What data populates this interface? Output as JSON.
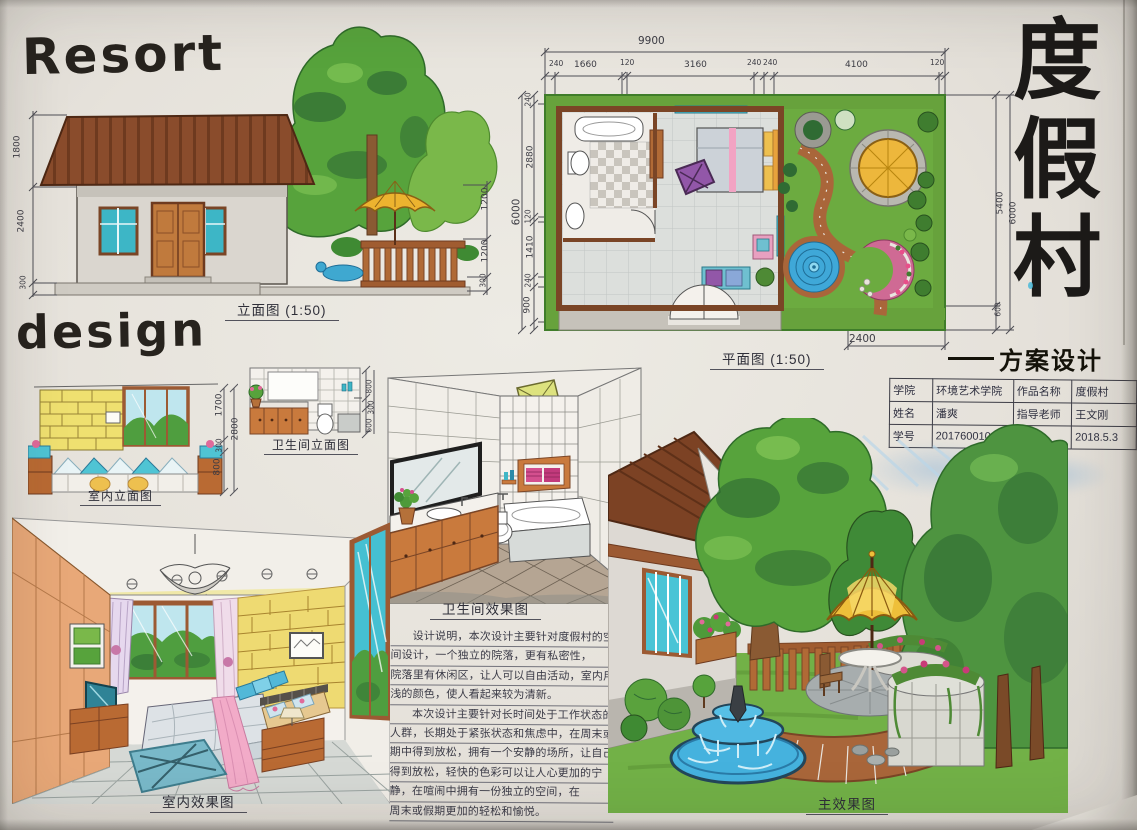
{
  "titles": {
    "resort": "Resort",
    "design": "design",
    "main_title_chars": [
      "度",
      "假",
      "村"
    ],
    "scheme_label": "方案设计"
  },
  "elevation": {
    "caption": "立面图 (1:50)",
    "dims_left": [
      "1800",
      "2400",
      "300"
    ],
    "dims_right": [
      "1200",
      "1200",
      "300"
    ]
  },
  "interior_elevation": {
    "caption": "室内立面图",
    "dims_right": [
      "1700",
      "300",
      "800"
    ],
    "dim_total": "2800"
  },
  "bath_elevation": {
    "caption": "卫生间立面图",
    "dims_right": [
      "800",
      "300",
      "600"
    ]
  },
  "floor_plan": {
    "caption": "平面图 (1:50)",
    "dim_total_top": "9900",
    "dims_top": [
      "240",
      "1660",
      "120",
      "3160",
      "240",
      "240",
      "4100",
      "120"
    ],
    "dim_total_left": "6000",
    "dims_left": [
      "240",
      "2880",
      "120",
      "1410",
      "240",
      "900"
    ],
    "dims_right": [
      "5400",
      "6000"
    ],
    "dim_right_bottom": "600",
    "dim_bottom": "2400"
  },
  "info_table": {
    "rows": [
      [
        "学院",
        "环境艺术学院",
        "作品名称",
        "度假村"
      ],
      [
        "姓名",
        "潘爽",
        "指导老师",
        "王文刚"
      ],
      [
        "学号",
        "201760010",
        "日期",
        "2018.5.3"
      ]
    ]
  },
  "bath_render": {
    "caption": "卫生间效果图"
  },
  "design_notes": {
    "lines": [
      "设计说明，本次设计主要针对度假村的空",
      "间设计，一个独立的院落，更有私密性，",
      "院落里有休闲区，让人可以自由活动，室内用较",
      "浅的颜色，使人看起来较为清新。",
      "本次设计主要针对长时间处于工作状态的",
      "人群，长期处于紧张状态和焦虑中，在周末或假",
      "期中得到放松，拥有一个安静的场所，让自己",
      "得到放松，轻快的色彩可以让人心更加的宁",
      "静，在喧闹中拥有一份独立的空间，在",
      "周末或假期更加的轻松和愉悦。"
    ]
  },
  "interior_render": {
    "caption": "室内效果图"
  },
  "main_render": {
    "caption": "主效果图"
  },
  "colors": {
    "paper": "#e6e2db",
    "ink": "#2c2a27",
    "roof_brown": "#7c4224",
    "wood_orange": "#c97a3d",
    "window_cyan": "#45bccd",
    "tree_green": "#55a23c",
    "grass_green": "#6fae44",
    "umbrella_yellow": "#eebf3a",
    "pool_blue": "#45b2de",
    "path_brick": "#a9663a",
    "accent_pink": "#f0a8c8"
  }
}
